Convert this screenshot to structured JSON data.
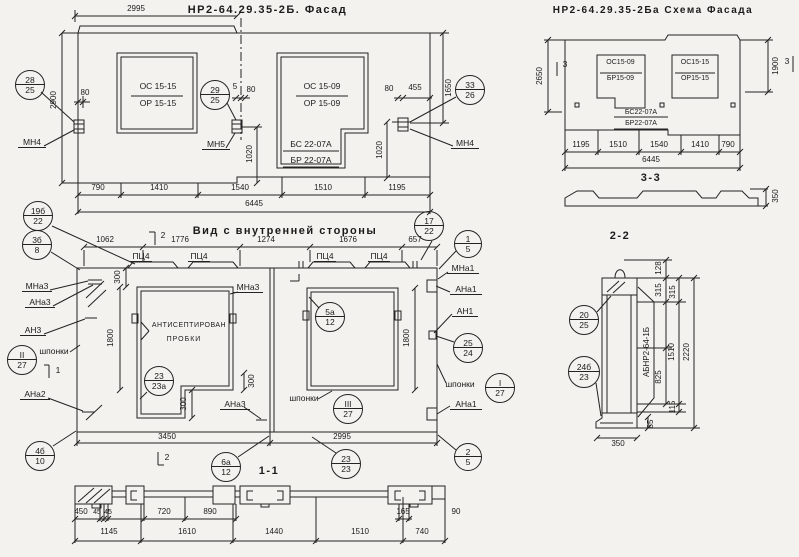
{
  "titles": {
    "facade": "НР2-64.29.35-2Б. Фасад",
    "schema": "НР2-64.29.35-2Ба Схема Фасада",
    "inner": "Вид с внутренней стороны",
    "s11": "1-1",
    "s22": "2-2",
    "s33": "3-3"
  },
  "facade": {
    "dim_top": "2995",
    "dim_left": "2900",
    "dim_right": "1650",
    "dim_1020_mid": "1020",
    "dim_1020_right": "1020",
    "dim_80_left": "80",
    "dim_5": "5",
    "dim_80_mid": "80",
    "dim_80_right": "80",
    "dim_455": "455",
    "win1": {
      "l1": "ОС 15-15",
      "l2": "ОР 15-15"
    },
    "win2": {
      "l1": "ОС 15-09",
      "l2": "ОР 15-09"
    },
    "door": {
      "l1": "БС 22-07А",
      "l2": "БР 22-07А"
    },
    "anchor_left": "МН4",
    "anchor_mid": "МН5",
    "anchor_right": "МН4",
    "dims_bottom": [
      "790",
      "1410",
      "1540",
      "1510",
      "1195"
    ],
    "dim_total": "6445",
    "bal_left": {
      "t": "28",
      "b": "25"
    },
    "bal_mid": {
      "t": "29",
      "b": "25"
    },
    "bal_right": {
      "t": "33",
      "b": "26"
    }
  },
  "schema": {
    "dim_left": "2650",
    "dim_right": "1900",
    "mark_left": "3",
    "mark_right": "3",
    "win1": {
      "l1": "ОС15-09",
      "l2": "БР15-09"
    },
    "win2": {
      "l1": "ОС15-15",
      "l2": "ОР15-15"
    },
    "door": {
      "l1": "БС22-07А",
      "l2": "БР22-07А"
    },
    "dims_bottom": [
      "1195",
      "1510",
      "1540",
      "1410",
      "790"
    ],
    "dim_total": "6445",
    "s33_dim": "350"
  },
  "inner": {
    "dims_top": [
      "1062",
      "1776",
      "1274",
      "1676",
      "657"
    ],
    "pad": "ПЦ4",
    "mark2_top": "2",
    "mark2_bottom": "2",
    "mark1": "1",
    "labels_left": [
      "МНа3",
      "АНа3",
      "АН3",
      "шпонки",
      "АНа2"
    ],
    "labels_right": [
      "МНа1",
      "АНа1",
      "АН1",
      "шпонки",
      "АНа1"
    ],
    "label_win_top": "МНа3",
    "label_win_bottom": "АНа3",
    "label_shponki_bottom": "шпонки",
    "note1": "АНТИСЕПТИРОВАН",
    "note2": "ПРОБКИ",
    "dim_300_top": "300",
    "dim_1800_left": "1800",
    "dim_300_mid": "300",
    "dim_300_bottom": "300",
    "dim_1800_right": "1800",
    "dims_bottom": [
      "3450",
      "2995"
    ],
    "bal": {
      "b19": {
        "t": "19б",
        "b": "22"
      },
      "b3": {
        "t": "3б",
        "b": "8"
      },
      "b17": {
        "t": "17",
        "b": "22"
      },
      "b1": {
        "t": "1",
        "b": "5"
      },
      "bII": {
        "t": "II",
        "b": "27"
      },
      "b5a": {
        "t": "5а",
        "b": "12"
      },
      "b25": {
        "t": "25",
        "b": "24"
      },
      "bI": {
        "t": "I",
        "b": "27"
      },
      "bIII": {
        "t": "III",
        "b": "27"
      },
      "b23a": {
        "t": "23",
        "b": "23а"
      },
      "b4": {
        "t": "4б",
        "b": "10"
      },
      "b6a": {
        "t": "6а",
        "b": "12"
      },
      "b23": {
        "t": "23",
        "b": "23"
      },
      "b2": {
        "t": "2",
        "b": "5"
      }
    }
  },
  "s11": {
    "dims_row1": [
      "450",
      "45",
      "45",
      "720",
      "890",
      "165",
      "90"
    ],
    "dims_row2": [
      "1145",
      "1610",
      "1440",
      "1510",
      "740"
    ]
  },
  "s22": {
    "label_vertical": "АБНР2-64-1Б",
    "dim_128": "128",
    "dim_315a": "315",
    "dim_315b": "315",
    "dim_1510": "1510",
    "dim_2220": "2220",
    "dim_825": "825",
    "dim_115": "115",
    "dim_85": "85",
    "dim_350": "350",
    "bal_top": {
      "t": "20",
      "b": "25"
    },
    "bal_bottom": {
      "t": "24б",
      "b": "23"
    }
  }
}
